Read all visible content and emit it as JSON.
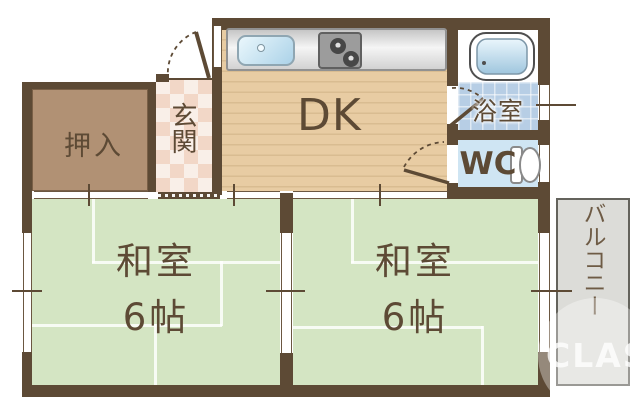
{
  "plan": {
    "rooms": {
      "closet": {
        "label": "押入"
      },
      "entrance": {
        "label": "玄関"
      },
      "dining_kitchen": {
        "label": "DK"
      },
      "bathroom": {
        "label": "浴室"
      },
      "toilet": {
        "label": "WC"
      },
      "japanese_room_left": {
        "name_line": "和室",
        "size_line": "6帖"
      },
      "japanese_room_right": {
        "name_line": "和室",
        "size_line": "6帖"
      },
      "balcony": {
        "label": "バルコニー"
      }
    },
    "watermark": {
      "text": "CLASM"
    },
    "icons": [
      "sink-icon",
      "stove-icon",
      "bathtub-icon",
      "toilet-icon",
      "entrance-door-swing-icon",
      "bathroom-door-swing-icon",
      "wc-door-swing-icon",
      "window-marker",
      "sliding-door-marker"
    ],
    "palette": {
      "wall": "#5d4a35",
      "tatami_green": "#d4e5c3",
      "wood_floor": "#e8cca3",
      "closet_fill": "#b19174",
      "entrance_tile": "#f2d7c7",
      "bath_tile": "#b7cee5",
      "wc_floor": "#cfe5f3",
      "balcony_fill": "#dcdcd8",
      "label_text": "#5d4a35"
    }
  }
}
